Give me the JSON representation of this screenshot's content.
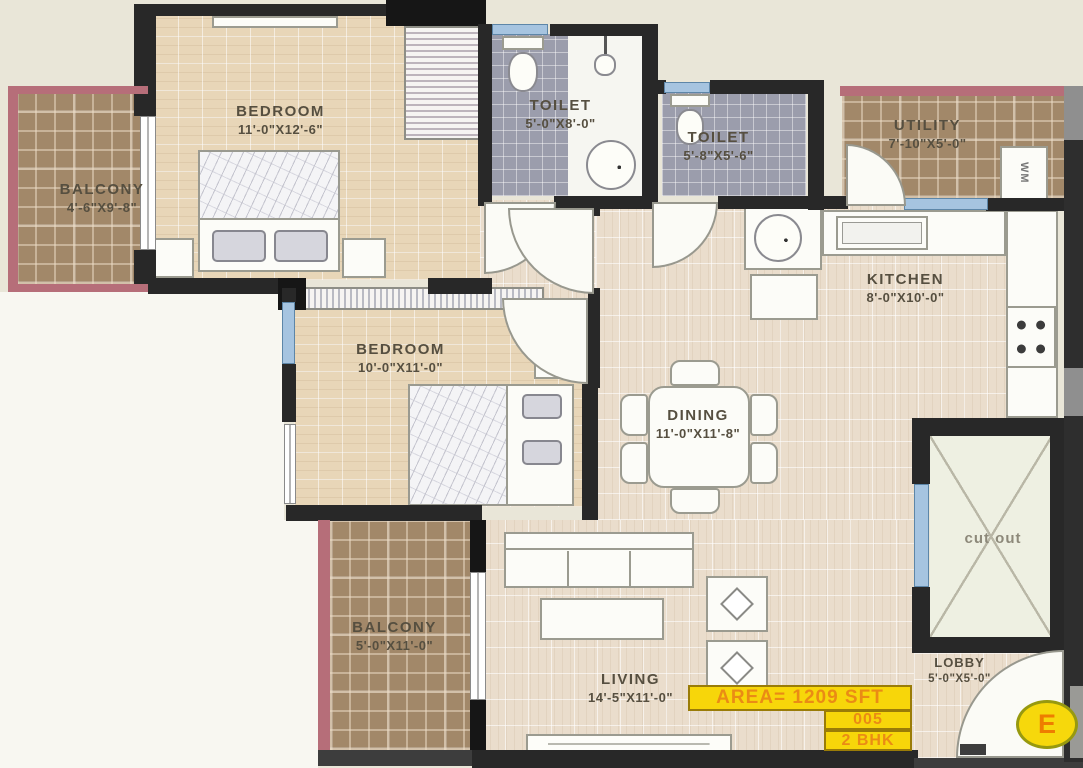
{
  "plan": {
    "rooms": [
      {
        "name": "BALCONY",
        "dims": "4'-6\"X9'-8\""
      },
      {
        "name": "BEDROOM",
        "dims": "11'-0\"X12'-6\""
      },
      {
        "name": "TOILET",
        "dims": "5'-0\"X8'-0\""
      },
      {
        "name": "TOILET",
        "dims": "5'-8\"X5'-6\""
      },
      {
        "name": "UTILITY",
        "dims": "7'-10\"X5'-0\""
      },
      {
        "name": "KITCHEN",
        "dims": "8'-0\"X10'-0\""
      },
      {
        "name": "BEDROOM",
        "dims": "10'-0\"X11'-0\""
      },
      {
        "name": "DINING",
        "dims": "11'-0\"X11'-8\""
      },
      {
        "name": "BALCONY",
        "dims": "5'-0\"X11'-0\""
      },
      {
        "name": "LIVING",
        "dims": "14'-5\"X11'-0\""
      },
      {
        "name": "LOBBY",
        "dims": "5'-0\"X5'-0\""
      },
      {
        "name": "cut out",
        "dims": ""
      }
    ],
    "appliances": {
      "washing_machine": "WM"
    },
    "badges": {
      "area": "AREA= 1209 SFT",
      "unit_number": "005",
      "unit_type": "2 BHK"
    },
    "compass": {
      "direction": "E"
    }
  },
  "colors": {
    "wall": "#282828",
    "floor_tan": "#e8d6b8",
    "floor_light": "#eaddcc",
    "balcony_plaid": "#a28869",
    "toilet_tile": "#9b9dac",
    "window_blue": "#a6c4e0",
    "railing_pink": "#b66e79",
    "badge_yellow": "#f7d60a",
    "badge_text": "#ea8b15"
  }
}
